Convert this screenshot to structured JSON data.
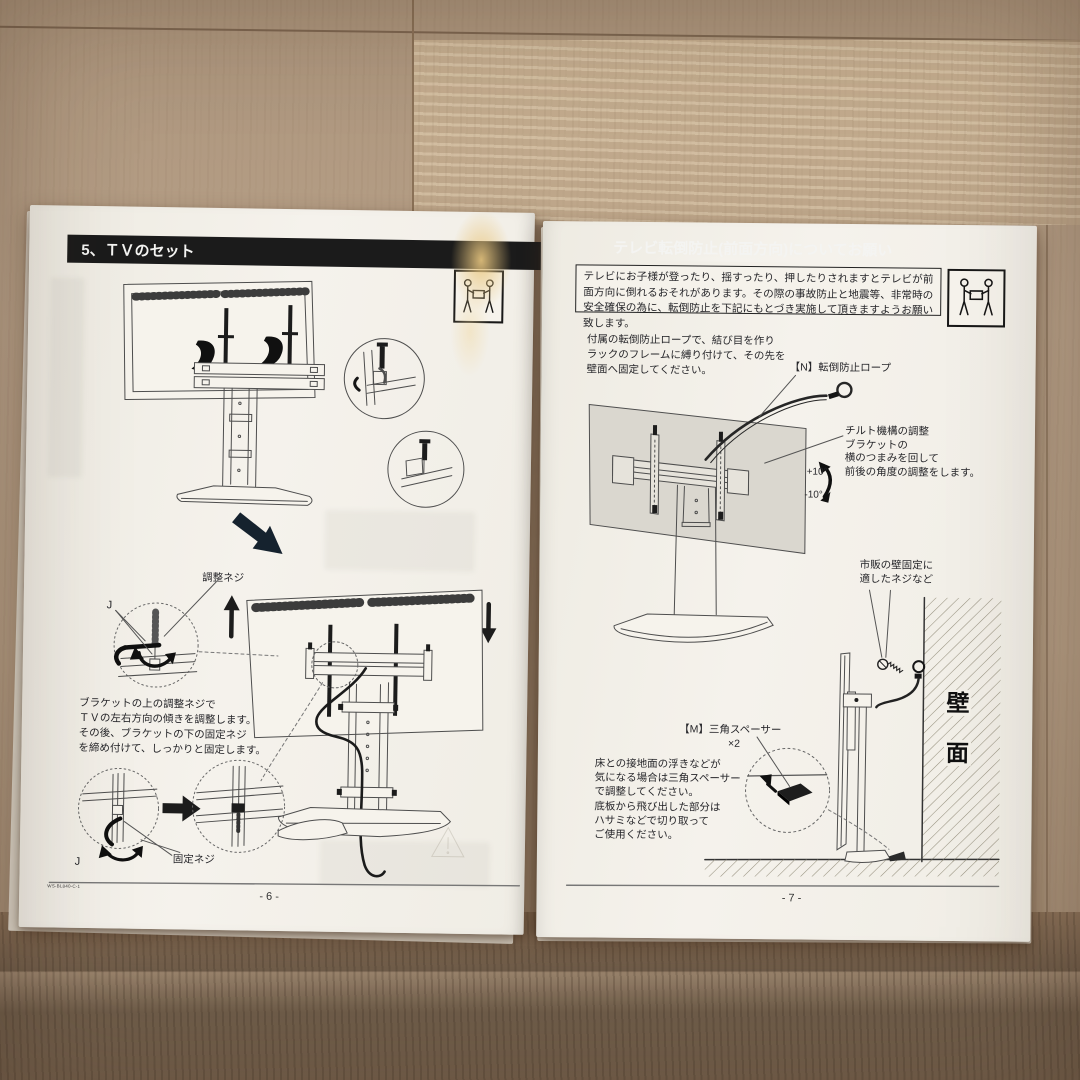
{
  "colors": {
    "paper": "#f3f0e8",
    "header_bar": "#1b1b1b",
    "floor_light": "#b29b81",
    "floor_dark": "#6f5c49",
    "line_art": "#4e4e4e"
  },
  "icons": {
    "carry": "two-person-carry-icon"
  },
  "pages": {
    "left": {
      "header": "5、ＴＶのセット",
      "labels": {
        "adjust_screw": "調整ネジ",
        "fix_screw": "固定ネジ",
        "j_top": "J",
        "j_bottom": "J"
      },
      "body_paragraph": "ブラケットの上の調整ネジで\nＴＶの左右方向の傾きを調整します。\nその後、ブラケットの下の固定ネジ\nを締め付けて、しっかりと固定します。",
      "footer": {
        "doc_code": "WS-BL840-C-1",
        "page_number": "- 6 -"
      }
    },
    "right": {
      "header": "テレビ転倒防止(前面方向)についてお願い",
      "warning": "テレビにお子様が登ったり、揺すったり、押したりされますとテレビが前面方向に倒れるおそれがあります。その際の事故防止と地震等、非常時の安全確保の為に、転倒防止を下記にもとづき実施して頂きますようお願い致します。",
      "intro": "付属の転倒防止ロープで、結び目を作り\nラックのフレームに縛り付けて、その先を\n壁面へ固定してください。",
      "labels": {
        "rope": "【N】転倒防止ロープ",
        "tilt": "チルト機構の調整\nブラケットの\n横のつまみを回して\n前後の角度の調整をします。",
        "plus10": "+10°",
        "minus10": "-10°",
        "wall_screw": "市販の壁固定に\n適したネジなど",
        "spacer": "【M】三角スペーサー",
        "spacer_qty": "×2",
        "wall_char_1": "壁",
        "wall_char_2": "面"
      },
      "spacer_paragraph": "床との接地面の浮きなどが\n気になる場合は三角スペーサー\nで調整してください。\n底板から飛び出した部分は\nハサミなどで切り取って\nご使用ください。",
      "footer": {
        "page_number": "- 7 -"
      }
    }
  }
}
